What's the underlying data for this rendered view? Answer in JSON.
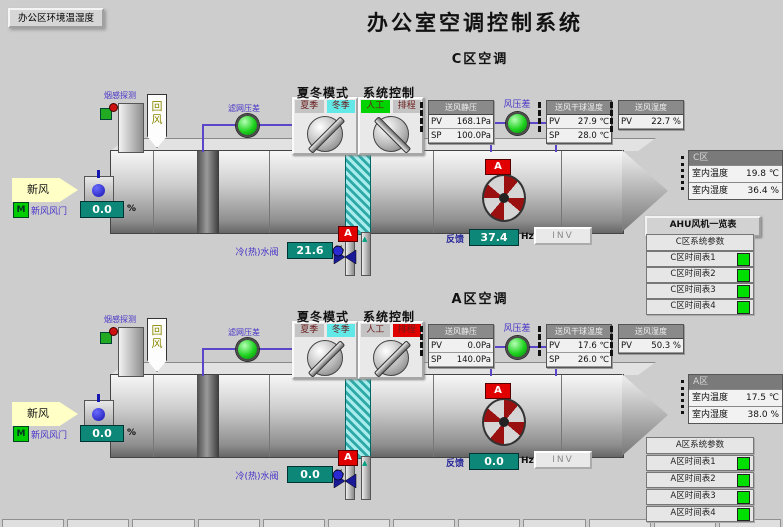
{
  "window": {
    "title": "办公室空调控制系统",
    "env_button": "办公区环境温湿度"
  },
  "colors": {
    "value_box": "#0d8878",
    "led_green": "#1ed21e",
    "alarm_red": "#e00000",
    "winter_cyan": "#63e8e8",
    "manual_green": "#00d400",
    "schedule_red": "#e00000"
  },
  "zones": [
    {
      "subtitle": "C区空调",
      "smoke": "烟感探测",
      "return_air": "回风",
      "fresh_air": "新风",
      "filter_dp": "滤网压差",
      "fan_dp": "风压差",
      "mode": {
        "title": "夏冬模式",
        "knob_deg": 45,
        "options": [
          {
            "label": "夏季",
            "bg": ""
          },
          {
            "label": "冬季",
            "bg": "#63e8e8"
          }
        ]
      },
      "ctrl": {
        "title": "系统控制",
        "knob_deg": -45,
        "options": [
          {
            "label": "人工",
            "bg": "#00d400"
          },
          {
            "label": "排程",
            "bg": ""
          }
        ]
      },
      "static_pressure": {
        "title": "送风静压",
        "pv_label": "PV",
        "pv": "168.1Pa",
        "sp_label": "SP",
        "sp": "100.0Pa"
      },
      "supply_temp": {
        "title": "送风干球温度",
        "pv_label": "PV",
        "pv": "27.9 ℃",
        "sp_label": "SP",
        "sp": "28.0 ℃"
      },
      "supply_hum": {
        "title": "送风湿度",
        "pv_label": "PV",
        "pv": "22.7 %"
      },
      "room": {
        "title": "C区",
        "temp_label": "室内温度",
        "temp": "19.8 ℃",
        "hum_label": "室内湿度",
        "hum": "36.4 %"
      },
      "damper": {
        "m": "M",
        "label": "新风风门",
        "value": "0.0",
        "unit": "%"
      },
      "valve": {
        "label": "冷(热)水阀",
        "value": "21.6",
        "unit": "%",
        "alarm": "A"
      },
      "feedback": {
        "label": "反馈",
        "value": "37.4",
        "unit": "Hz",
        "inv": "INV"
      },
      "fan_alarm": "A"
    },
    {
      "subtitle": "A区空调",
      "smoke": "烟感探测",
      "return_air": "回风",
      "fresh_air": "新风",
      "filter_dp": "滤网压差",
      "fan_dp": "风压差",
      "mode": {
        "title": "夏冬模式",
        "knob_deg": 45,
        "options": [
          {
            "label": "夏季",
            "bg": ""
          },
          {
            "label": "冬季",
            "bg": "#63e8e8"
          }
        ]
      },
      "ctrl": {
        "title": "系统控制",
        "knob_deg": 45,
        "options": [
          {
            "label": "人工",
            "bg": ""
          },
          {
            "label": "排程",
            "bg": "#e00000"
          }
        ]
      },
      "static_pressure": {
        "title": "送风静压",
        "pv_label": "PV",
        "pv": "0.0Pa",
        "sp_label": "SP",
        "sp": "140.0Pa"
      },
      "supply_temp": {
        "title": "送风干球温度",
        "pv_label": "PV",
        "pv": "17.6 ℃",
        "sp_label": "SP",
        "sp": "26.0 ℃"
      },
      "supply_hum": {
        "title": "送风湿度",
        "pv_label": "PV",
        "pv": "50.3 %"
      },
      "room": {
        "title": "A区",
        "temp_label": "室内温度",
        "temp": "17.5 ℃",
        "hum_label": "室内湿度",
        "hum": "38.0 %"
      },
      "damper": {
        "m": "M",
        "label": "新风风门",
        "value": "0.0",
        "unit": "%"
      },
      "valve": {
        "label": "冷(热)水阀",
        "value": "0.0",
        "unit": "%",
        "alarm": "A"
      },
      "feedback": {
        "label": "反馈",
        "value": "0.0",
        "unit": "Hz",
        "inv": "INV"
      },
      "fan_alarm": "A"
    }
  ],
  "menu": {
    "header": "AHU风机一览表",
    "indicator": "#00e000",
    "groups": [
      {
        "params": "C区系统参数",
        "schedules": [
          "C区时间表1",
          "C区时间表2",
          "C区时间表3",
          "C区时间表4"
        ]
      },
      {
        "params": "A区系统参数",
        "schedules": [
          "A区时间表1",
          "A区时间表2",
          "A区时间表3",
          "A区时间表4"
        ]
      }
    ]
  }
}
